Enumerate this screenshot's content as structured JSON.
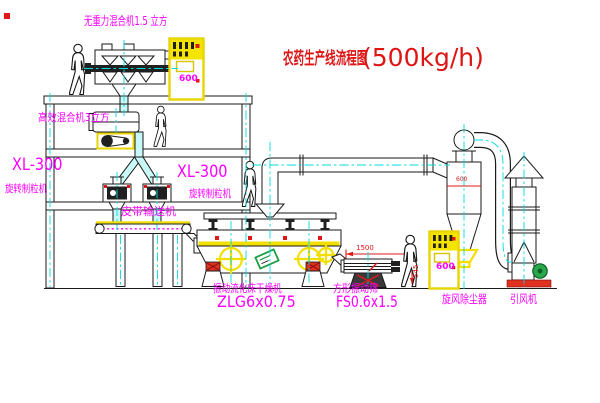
{
  "title": {
    "text": "农药生产线流程图",
    "capacity": "(500kg/h)"
  },
  "equipment": {
    "gravity_free_mixer": {
      "label": "无重力混合机1.5 立方"
    },
    "high_efficiency_mixer": {
      "label": "高效混合机3立方"
    },
    "granulators": [
      {
        "model": "XL-300",
        "name": "旋转制粒机"
      },
      {
        "model": "XL-300",
        "name": "旋转制粒机"
      }
    ],
    "belt_conveyor": {
      "label": "皮带输送机"
    },
    "fluid_bed_dryer": {
      "name": "振动流化床干燥机",
      "model": "ZLG6x0.75"
    },
    "square_vibrating_screen": {
      "name": "方形振动筛",
      "model": "FS0.6x1.5"
    },
    "cyclone_dust_collector": {
      "name": "旋风除尘器"
    },
    "induced_draft_fan": {
      "name": "引风机"
    },
    "control_cabinets": [
      {
        "code": "600"
      },
      {
        "code": "600"
      }
    ]
  },
  "dimensions": {
    "screen_length": "1500",
    "screen_height": "545",
    "cyclone_diameter": "600"
  },
  "figures": {
    "person_count": 4
  },
  "colors": {
    "line": "#1a1a1a",
    "centerline_cyan": "#00dcdc",
    "highlight_yellow": "#f2df00",
    "label_magenta": "#ff00ff",
    "title_red": "#dd1515",
    "accent_red": "#e01818",
    "motor_green": "#2aa84a"
  }
}
